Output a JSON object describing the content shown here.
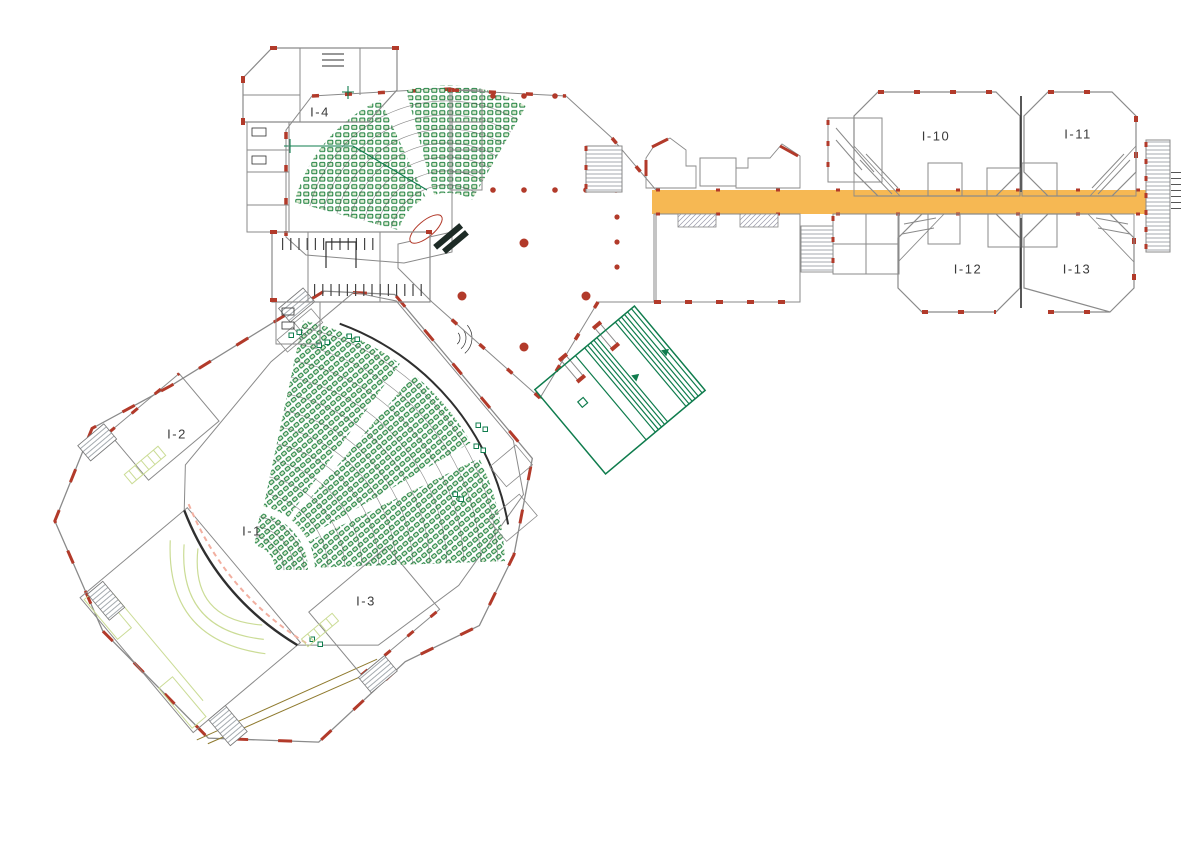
{
  "plan": {
    "type": "architectural-floor-plan",
    "rooms": [
      {
        "id": "i-1",
        "label": "I-1",
        "x": 252,
        "y": 531
      },
      {
        "id": "i-2",
        "label": "I-2",
        "x": 177,
        "y": 434
      },
      {
        "id": "i-3",
        "label": "I-3",
        "x": 366,
        "y": 601
      },
      {
        "id": "i-4",
        "label": "I-4",
        "x": 320,
        "y": 112
      },
      {
        "id": "i-10",
        "label": "I-10",
        "x": 936,
        "y": 136
      },
      {
        "id": "i-11",
        "label": "I-11",
        "x": 1078,
        "y": 134
      },
      {
        "id": "i-12",
        "label": "I-12",
        "x": 968,
        "y": 269
      },
      {
        "id": "i-13",
        "label": "I-13",
        "x": 1077,
        "y": 269
      }
    ],
    "colors": {
      "orange": "#F6B853",
      "peach": "#FADCA4",
      "seat-fill": "#DDEBD2",
      "seat-stroke": "#1B7F3D",
      "green": "#0F7C4D",
      "wall": "#B23A2A",
      "gray": "#8A8A8A",
      "dark": "#2F2F2F",
      "stage-line": "#CBDC96",
      "pink": "#F2AFA0",
      "olive": "#8F7A2E",
      "label": "#3A3A3A",
      "desk": "#1D2B26"
    }
  }
}
